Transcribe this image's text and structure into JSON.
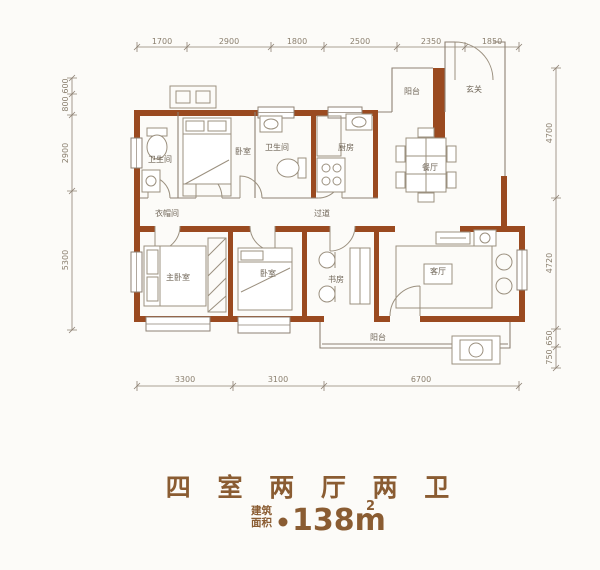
{
  "colors": {
    "bg": "#fcfbf8",
    "wall": "#9a4a20",
    "line": "#8e8274",
    "fxline": "#9b907f",
    "dimtext": "#8a7f6e",
    "roomtext": "#6f6557",
    "title": "#8a5c32"
  },
  "title": {
    "main": "四 室 两 厅 两 卫",
    "area_prefix_1": "建筑",
    "area_prefix_2": "面积",
    "area_value": "138m",
    "area_superscript": "2"
  },
  "dimensions": {
    "top": [
      "1700",
      "2900",
      "1800",
      "2500",
      "2350",
      "1850"
    ],
    "bottom": [
      "3300",
      "3100",
      "6700"
    ],
    "left": [
      "600",
      "800",
      "2900",
      "5300"
    ],
    "right": [
      "4700",
      "4720",
      "650",
      "750"
    ]
  },
  "rooms": [
    {
      "id": "bathroom-1",
      "label": "卫生间"
    },
    {
      "id": "bedroom-top",
      "label": "卧室"
    },
    {
      "id": "bathroom-2",
      "label": "卫生间"
    },
    {
      "id": "kitchen",
      "label": "厨房"
    },
    {
      "id": "balcony-top",
      "label": "阳台"
    },
    {
      "id": "entry",
      "label": "玄关"
    },
    {
      "id": "cloakroom",
      "label": "衣帽间"
    },
    {
      "id": "corridor",
      "label": "过道"
    },
    {
      "id": "dining-room",
      "label": "餐厅"
    },
    {
      "id": "master-bedroom",
      "label": "主卧室"
    },
    {
      "id": "bedroom-2",
      "label": "卧室"
    },
    {
      "id": "study",
      "label": "书房"
    },
    {
      "id": "living-room",
      "label": "客厅"
    },
    {
      "id": "balcony-bottom",
      "label": "阳台"
    }
  ]
}
